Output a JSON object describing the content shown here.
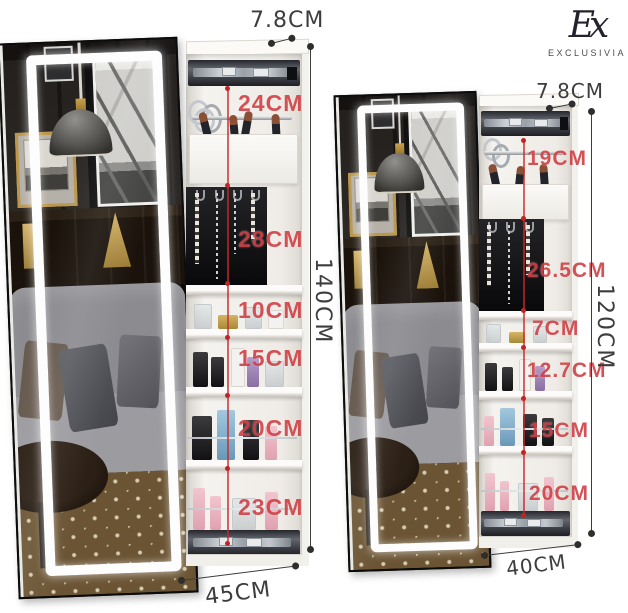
{
  "logo": {
    "monogram": "Ex",
    "brand": "EXCLUSIVIA"
  },
  "palette": {
    "dimension_red": "#ce3a40",
    "dimension_dark": "#3d3d3d",
    "led_white": "#ffffff",
    "cabinet_white": "#f5f3ef"
  },
  "left_cabinet": {
    "depth_label": "7.8CM",
    "height_label": "140CM",
    "width_label": "45CM",
    "sections": [
      {
        "label": "24CM"
      },
      {
        "label": "28CM"
      },
      {
        "label": "10CM"
      },
      {
        "label": "15CM"
      },
      {
        "label": "20CM"
      },
      {
        "label": "23CM"
      }
    ]
  },
  "right_cabinet": {
    "depth_label": "7.8CM",
    "height_label": "120CM",
    "width_label": "40CM",
    "sections": [
      {
        "label": "19CM"
      },
      {
        "label": "26.5CM"
      },
      {
        "label": "7CM"
      },
      {
        "label": "12.7CM"
      },
      {
        "label": "15CM"
      },
      {
        "label": "20CM"
      }
    ]
  }
}
